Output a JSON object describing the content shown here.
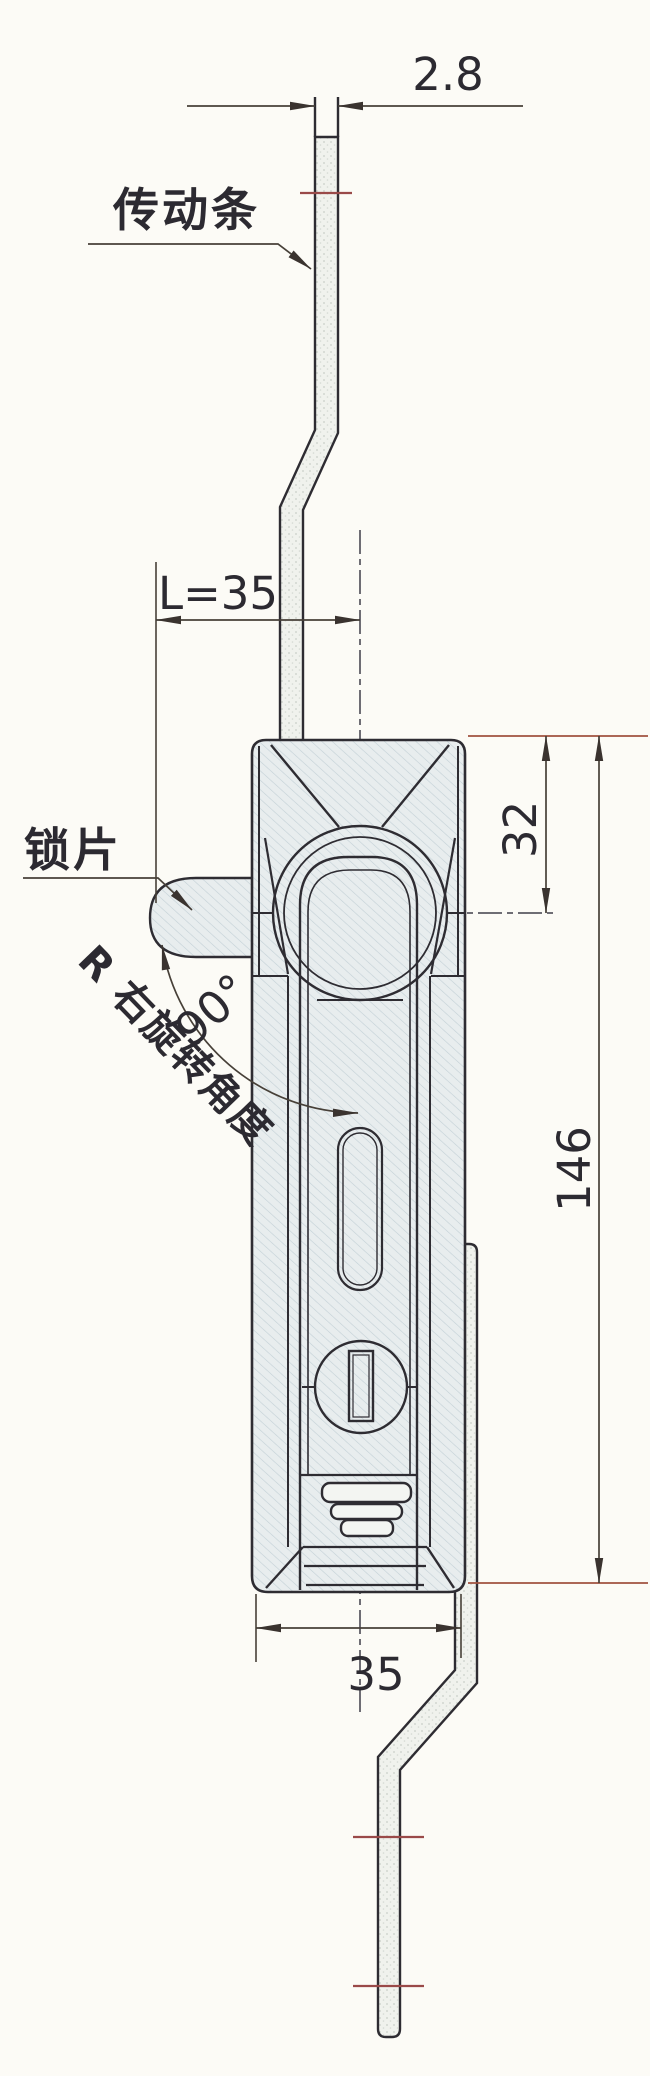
{
  "drawing": {
    "labels": {
      "transmission_bar": "传动条",
      "lock_tab": "锁片",
      "rotation_note": "R 右旋转角度",
      "rotation_angle": "90°"
    },
    "dimensions": {
      "bar_thickness": "2.8",
      "tab_length": "L=35",
      "top_to_axis": "32",
      "body_height": "146",
      "body_width": "35"
    },
    "colors": {
      "paper": "#fcfbf6",
      "ink": "#2e2c32",
      "dimension_line": "#474038",
      "accent_red": "#9c4f3e",
      "body_fill": "#e8edee",
      "bar_fill": "#f0f2ed"
    }
  }
}
